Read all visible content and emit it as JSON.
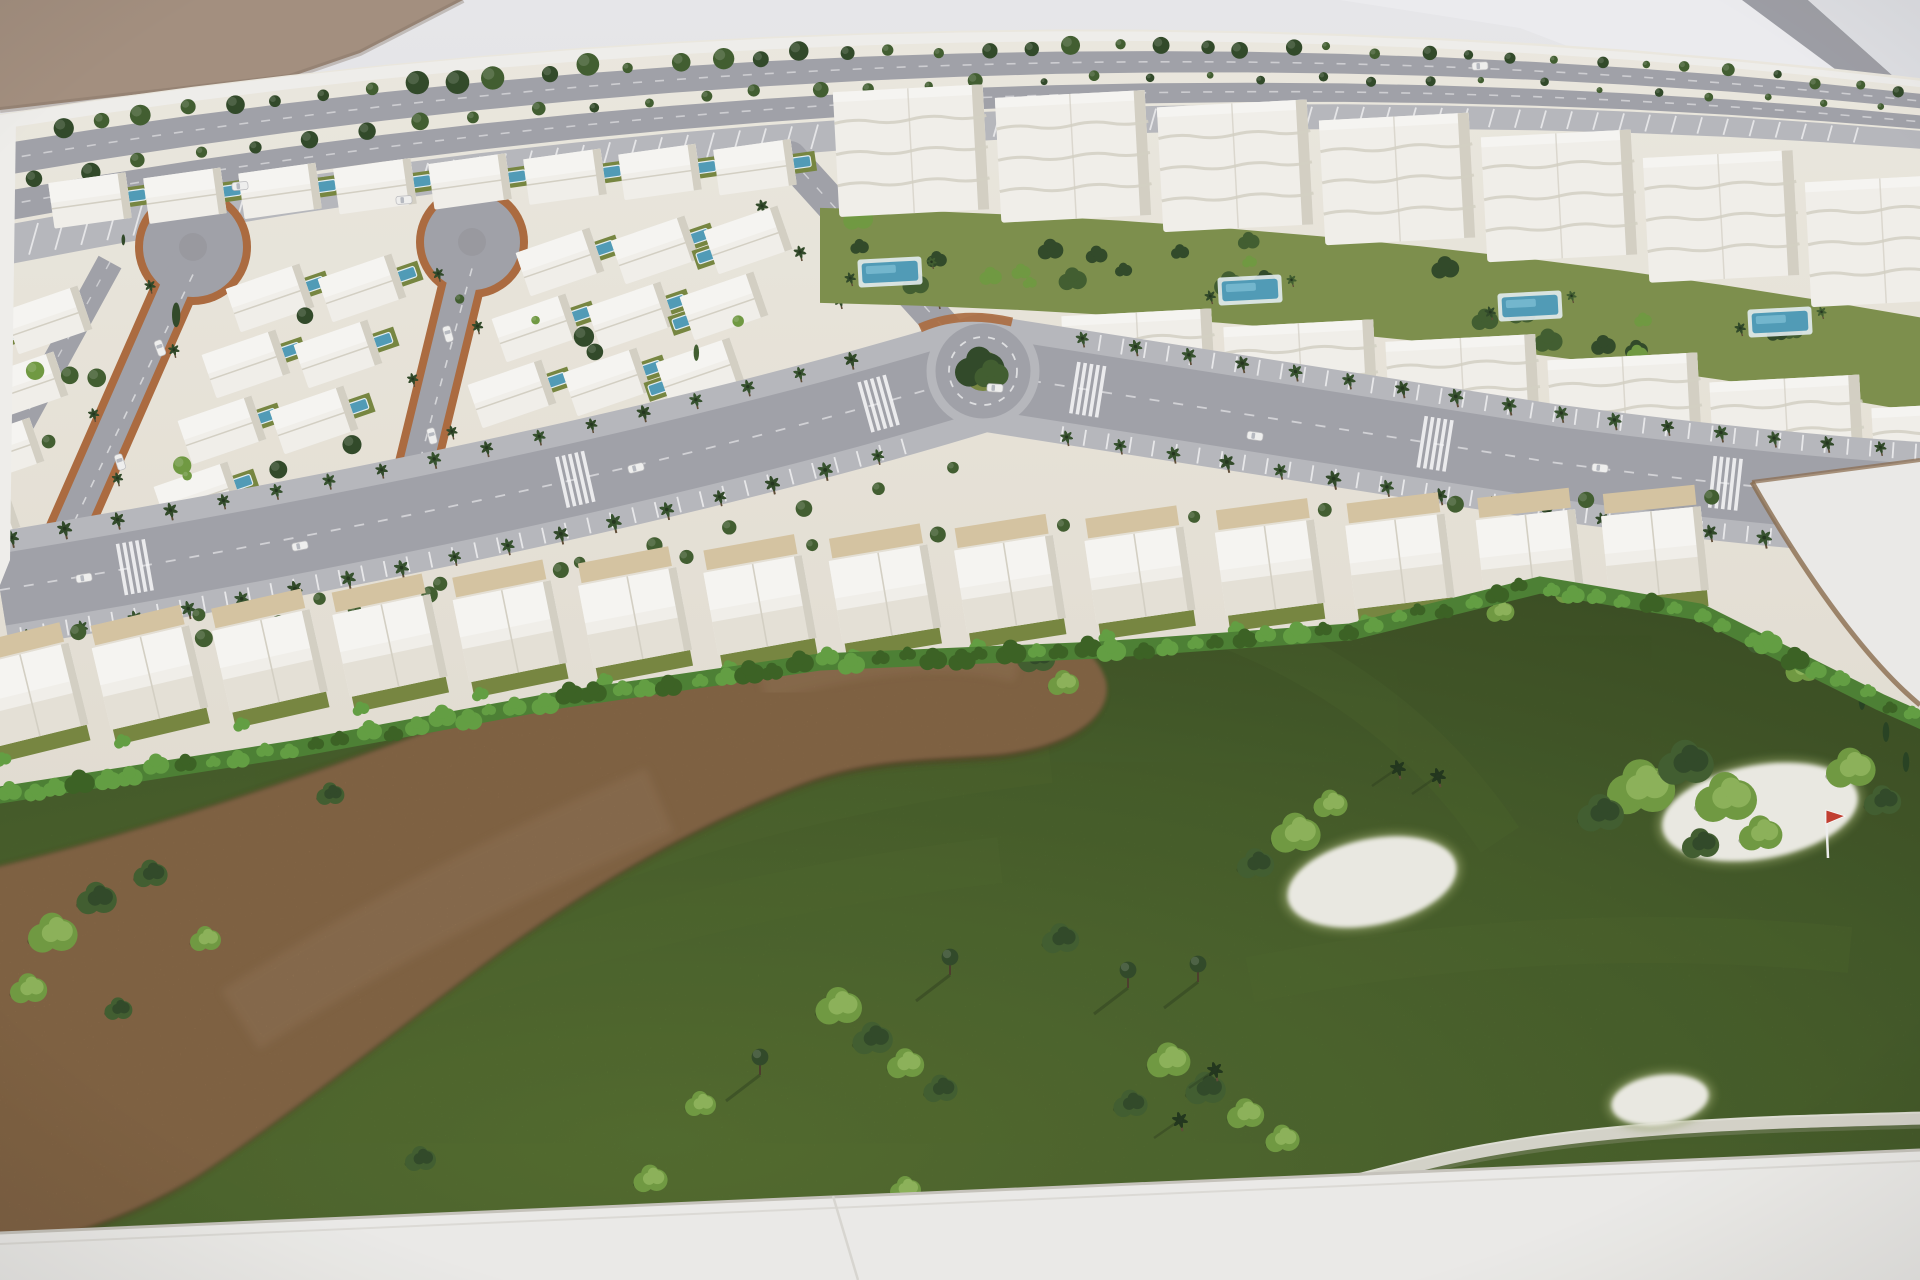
{
  "scene": {
    "kind": "photograph",
    "subject": "architectural-scale-model",
    "description": "Overhead photo of a white architectural maquette of a coastal resort development: rows of white villas with blue pools around two lollipop cul-de-sacs, white apartment blocks with garden pools, a palm-lined avenue with a roundabout, a curved row of townhouses, and a model golf course with a sandy waste area, white sand bunkers and a tiny red flag."
  },
  "palette": {
    "bg": "#d8d8db",
    "bg_light": "#ebebee",
    "bg_band": "#f1f1f3",
    "bg_corner": "#e3e4e7",
    "stripe": "#9fa0a6",
    "tan": "#a5907e",
    "tan_shadow": "#7e6c5c",
    "cream_hi": "#f0ece2",
    "cream_lo": "#e6e1d4",
    "white_wall": "#f4f3ef",
    "road": "#a2a3a9",
    "road_light": "#b9babe",
    "road_dark": "#94959b",
    "terracotta": "#ad6a3b",
    "plot_edge": "#8a6a4a",
    "villa": "#f6f4ee",
    "villa_hi": "#fbfaf6",
    "villa_shadow": "#d7d3c6",
    "pool": "#4e9cb8",
    "pool_hi": "#7cc0d6",
    "deck": "#e8f2f5",
    "lawn": "#76863d",
    "garden": "#7d9049",
    "hedge": "#4a8030",
    "hedge_hi": "#61a03f",
    "hedge_dark": "#38601f",
    "grass_hi": "#5f7e33",
    "grass": "#4f6b2b",
    "grass_dark": "#3e5422",
    "brown": "#97724b",
    "brown_hi": "#a8875f",
    "brown_dark": "#5e3d20",
    "bunker": "#efeee5",
    "cart": "#ebe9e0",
    "tree_dark": "#2e4724",
    "tree_mid": "#3f5c2c",
    "tree_light": "#6f9a3e",
    "shadow": "#1f2e14",
    "base": "#f0efeb",
    "base_edge": "#c9c6bd",
    "flag_red": "#c43c2c",
    "car": "#f4f4f2"
  },
  "geometry": {
    "top_edge": {
      "a": 118,
      "b": -0.155,
      "c": 7.1e-05,
      "taper": 0.55
    },
    "bands": {
      "wall": [
        -3,
        11
      ],
      "trees1": 20,
      "road1": [
        26,
        58
      ],
      "trees2": 66,
      "road2": [
        74,
        104
      ],
      "parking": [
        108,
        148
      ],
      "tick": [
        112,
        144
      ],
      "tree1_step": 44,
      "tree2_step": 56,
      "tick_step": 26
    },
    "tan_corner": "M 0,0 L 463,0 L 360,53 L 290,77 L 0,110 Z",
    "bg_band_poly": "M 1340,0 L 1920,0 L 1920,180 L 1520,28 Z",
    "bg_stripe_poly": "M 1742,0 L 1808,0 L 1920,100 L 1920,132 Z",
    "bg_corner_poly": "M 1808,0 L 1920,0 L 1920,100 Z",
    "ground_bottom": [
      [
        0,
        795
      ],
      [
        300,
        748
      ],
      [
        560,
        700
      ],
      [
        820,
        662
      ],
      [
        1100,
        650
      ],
      [
        1350,
        632
      ],
      [
        1540,
        585
      ],
      [
        1700,
        612
      ],
      [
        1800,
        662
      ],
      [
        1880,
        702
      ],
      [
        1925,
        722
      ]
    ],
    "left_road": {
      "x1": 110,
      "y1": 262,
      "x2": 8,
      "y2": 448,
      "w": 26
    },
    "vert_road": {
      "x1": 790,
      "y1": 158,
      "x2": 975,
      "y2": 362,
      "w": 34
    },
    "loops": [
      {
        "bulb": [
          193,
          247
        ],
        "end": [
          52,
          568
        ],
        "r": 50,
        "w": 30
      },
      {
        "bulb": [
          472,
          242
        ],
        "end": [
          408,
          505
        ],
        "r": 48,
        "w": 30
      }
    ],
    "villa_cols": [
      [
        48,
        320
      ],
      [
        270,
        298
      ],
      [
        362,
        288
      ],
      [
        560,
        262
      ],
      [
        655,
        250
      ],
      [
        748,
        240
      ]
    ],
    "villa_step": [
      -24,
      66
    ],
    "villas_per_col": 5,
    "villa_top_row": {
      "x0": 90,
      "dx": 95,
      "y0": 205,
      "slope": -0.05,
      "n": 8
    },
    "avenue": {
      "path": "M 0,590 C 400,525 750,445 983,373 C 1150,400 1350,430 1550,462 C 1700,482 1820,494 1920,500",
      "road_w": 72,
      "verge_w": 116,
      "palm_step": 54,
      "tick_step": 23
    },
    "crosswalk_s": [
      0.07,
      0.3,
      0.46,
      0.57,
      0.75,
      0.9
    ],
    "roundabout": {
      "cx": 983,
      "cy": 371,
      "r": 52
    },
    "townhouses": {
      "xs": [
        30,
        150,
        270,
        390,
        510,
        635,
        760,
        885,
        1010,
        1140,
        1270,
        1400,
        1530,
        1655
      ],
      "ya": 700,
      "yb": -0.155,
      "yc": 4e-05,
      "rot0": -14,
      "rot_k": 0.005
    },
    "apartments": {
      "rowA_x": [
        836,
        998,
        1160,
        1322,
        1484,
        1646,
        1808
      ],
      "rowA_h": 125,
      "rowB_x": [
        1064,
        1226,
        1388,
        1550,
        1712,
        1874
      ],
      "rowB_h": 105,
      "block_w": 150,
      "top_off": 48,
      "top_slope": 0.06,
      "rowB_off": 215,
      "pools": [
        [
          890,
          272
        ],
        [
          1250,
          290
        ],
        [
          1530,
          306
        ],
        [
          1780,
          322
        ]
      ]
    },
    "wedge": "M 1752,482 L 1920,460 L 1920,705 C 1868,662 1808,580 1752,482 Z",
    "side_stub": "M 1736,446 L 1800,438 L 1830,470 L 1756,480 Z",
    "brown_path": "M -15,872 C 160,830 330,770 500,706 C 640,658 800,620 930,614 C 1020,610 1090,640 1102,684 C 1110,722 1060,752 990,758 C 910,764 860,762 790,790 C 690,830 600,880 500,952 C 400,1026 300,1108 195,1178 C 120,1224 40,1248 -15,1252 Z",
    "mow_stripes": [
      "M 150,1060 C 400,930 700,800 1050,760",
      "M 60,1140 C 350,1010 650,900 1000,860",
      "M 1150,600 C 1300,640 1420,720 1500,840",
      "M 1250,980 C 1450,940 1650,930 1850,950"
    ],
    "cart_path": "M 992,1284 C 1120,1244 1290,1196 1430,1162 C 1580,1126 1760,1122 1925,1118",
    "base_path": "M 0,1233 L 1920,1150 L 1920,1280 L 0,1280 Z",
    "base_crease": [
      833,
      1196,
      858,
      1280
    ],
    "bunkers": [
      [
        1372,
        882,
        92,
        48,
        -12
      ],
      [
        1760,
        812,
        105,
        52,
        -10
      ],
      [
        1660,
        1100,
        55,
        30,
        -8
      ]
    ],
    "flag": {
      "x": 1826,
      "y": 812
    },
    "golf_bushes": [
      [
        497,
        695,
        12,
        0
      ],
      [
        540,
        678,
        13,
        1
      ],
      [
        583,
        658,
        11,
        0
      ],
      [
        627,
        641,
        12,
        1
      ],
      [
        672,
        628,
        10,
        0
      ],
      [
        718,
        617,
        13,
        1
      ],
      [
        764,
        609,
        11,
        0
      ],
      [
        812,
        605,
        14,
        1
      ],
      [
        860,
        607,
        11,
        0
      ],
      [
        908,
        614,
        13,
        1
      ],
      [
        954,
        625,
        12,
        0
      ],
      [
        998,
        640,
        14,
        1
      ],
      [
        1036,
        659,
        12,
        0
      ],
      [
        1063,
        684,
        10,
        1
      ],
      [
        52,
        935,
        16,
        1
      ],
      [
        96,
        900,
        13,
        0
      ],
      [
        28,
        990,
        12,
        1
      ],
      [
        150,
        875,
        11,
        0
      ],
      [
        205,
        940,
        10,
        1
      ],
      [
        118,
        1010,
        9,
        0
      ],
      [
        838,
        1008,
        15,
        1
      ],
      [
        872,
        1040,
        13,
        0
      ],
      [
        905,
        1065,
        12,
        1
      ],
      [
        940,
        1090,
        11,
        0
      ],
      [
        700,
        1105,
        10,
        1
      ],
      [
        1060,
        940,
        12,
        0
      ],
      [
        650,
        1180,
        11,
        1
      ],
      [
        420,
        1160,
        10,
        0
      ],
      [
        330,
        795,
        9,
        0
      ],
      [
        1640,
        790,
        22,
        1
      ],
      [
        1685,
        765,
        18,
        0
      ],
      [
        1725,
        800,
        20,
        1
      ],
      [
        1600,
        815,
        15,
        0
      ],
      [
        1760,
        835,
        14,
        1
      ],
      [
        1700,
        845,
        12,
        0
      ],
      [
        1850,
        770,
        16,
        1
      ],
      [
        1882,
        802,
        12,
        0
      ],
      [
        1295,
        835,
        16,
        1
      ],
      [
        1255,
        865,
        12,
        0
      ],
      [
        1330,
        805,
        11,
        1
      ],
      [
        1570,
        592,
        10,
        1
      ],
      [
        1620,
        578,
        10,
        0
      ],
      [
        1500,
        612,
        9,
        1
      ],
      [
        1762,
        642,
        10,
        0
      ],
      [
        1802,
        670,
        11,
        1
      ],
      [
        1168,
        1062,
        14,
        1
      ],
      [
        1205,
        1090,
        13,
        0
      ],
      [
        1245,
        1115,
        12,
        1
      ],
      [
        1130,
        1105,
        11,
        0
      ],
      [
        1282,
        1140,
        11,
        1
      ],
      [
        905,
        1190,
        10,
        1
      ],
      [
        1025,
        1232,
        9,
        0
      ]
    ],
    "golf_trees": [
      [
        1128,
        988
      ],
      [
        1198,
        982
      ],
      [
        950,
        975
      ],
      [
        760,
        1075
      ]
    ],
    "golf_palms": [
      [
        1398,
        768
      ],
      [
        1438,
        776
      ],
      [
        1215,
        1070
      ],
      [
        1180,
        1120
      ],
      [
        590,
        1215
      ]
    ],
    "golf_cypress": [
      [
        1862,
        700
      ],
      [
        1886,
        732
      ],
      [
        1906,
        762
      ],
      [
        1020,
        628
      ],
      [
        1060,
        648
      ]
    ],
    "cars": [
      [
        300,
        546,
        -11
      ],
      [
        636,
        468,
        -14
      ],
      [
        1255,
        436,
        8
      ],
      [
        1600,
        468,
        6
      ],
      [
        84,
        578,
        -9
      ],
      [
        404,
        200,
        -4
      ],
      [
        1480,
        66,
        -3
      ],
      [
        160,
        348,
        70
      ],
      [
        120,
        462,
        72
      ],
      [
        448,
        334,
        74
      ],
      [
        432,
        436,
        76
      ],
      [
        240,
        186,
        -5
      ],
      [
        995,
        388,
        4
      ]
    ]
  }
}
